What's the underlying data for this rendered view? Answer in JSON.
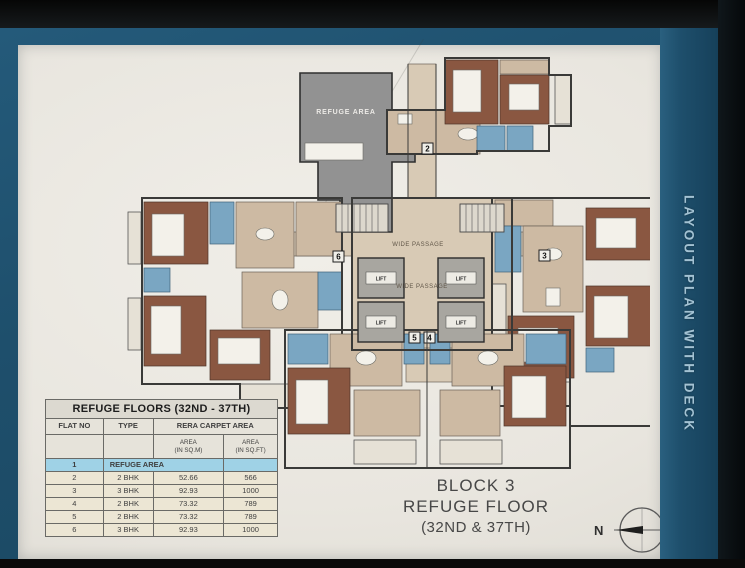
{
  "side_band": {
    "label": "LAYOUT PLAN WITH DECK"
  },
  "title_block": {
    "line1": "BLOCK 3",
    "line2": "REFUGE FLOOR",
    "line3": "(32ND & 37TH)"
  },
  "compass": {
    "label": "N"
  },
  "table": {
    "title": "REFUGE FLOORS (32ND - 37TH)",
    "columns": [
      "FLAT NO",
      "TYPE",
      "RERA CARPET AREA"
    ],
    "subcolumns": [
      {
        "line1": "AREA",
        "line2": "(IN SQ.M)"
      },
      {
        "line1": "AREA",
        "line2": "(IN SQ.FT)"
      }
    ],
    "rows": [
      {
        "flat_no": "1",
        "type": "REFUGE AREA",
        "sqm": "",
        "sqft": ""
      },
      {
        "flat_no": "2",
        "type": "2 BHK",
        "sqm": "52.66",
        "sqft": "566"
      },
      {
        "flat_no": "3",
        "type": "3 BHK",
        "sqm": "92.93",
        "sqft": "1000"
      },
      {
        "flat_no": "4",
        "type": "2 BHK",
        "sqm": "73.32",
        "sqft": "789"
      },
      {
        "flat_no": "5",
        "type": "2 BHK",
        "sqm": "73.32",
        "sqft": "789"
      },
      {
        "flat_no": "6",
        "type": "3 BHK",
        "sqm": "92.93",
        "sqft": "1000"
      }
    ]
  },
  "plan": {
    "refuge_label": "REFUGE AREA",
    "lift_label": "LIFT",
    "passage_label": "WIDE PASSAGE",
    "markers": [
      "2",
      "3",
      "4",
      "5",
      "6"
    ]
  },
  "colors": {
    "teal-band": "#1e4f6c",
    "paper": "#e9e6df",
    "wall": "#3a3a38",
    "room-tan": "#cdbaa3",
    "bedroom-brown": "#8a5741",
    "bath-blue": "#7aa6c2",
    "refuge-gray": "#929292",
    "highlight-cyan": "#9fd2e6",
    "band-text": "#a3c2d3"
  }
}
